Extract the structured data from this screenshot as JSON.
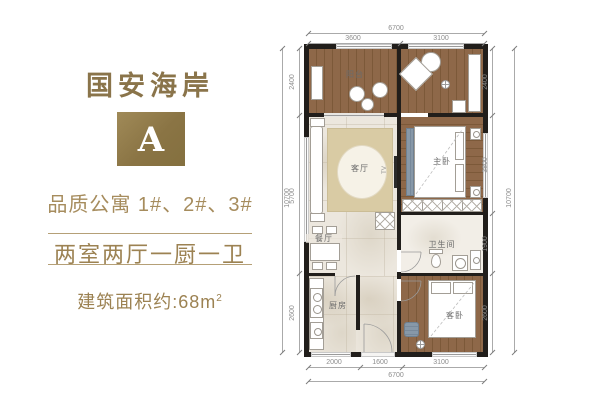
{
  "brand": {
    "title": "国安海岸",
    "unit_label": "A",
    "subtitle": "品质公寓 1#、2#、3#",
    "layout_text": "两室两厅一厨一卫",
    "area_prefix": "建筑面积约:68m",
    "area_sup": "2"
  },
  "colors": {
    "gold_text": "#8a744a",
    "gold_badge": "#8a7444",
    "divider": "#b5a077",
    "wall": "#211e1b",
    "wood_floor": "#8e6849",
    "tile_floor": "#ece7de",
    "rug": "#d9cba4",
    "accent_blue": "#8798a8",
    "dim_text": "#8d8d8d"
  },
  "plan": {
    "rooms": {
      "balcony": "阳台",
      "living": "客厅",
      "dining": "餐厅",
      "kitchen": "厨房",
      "bath": "卫生间",
      "master": "主卧",
      "guest": "客卧",
      "tv": "TV"
    },
    "dims": {
      "top_total": "6700",
      "top_segs": [
        "3600",
        "3100"
      ],
      "bottom_segs": [
        "2000",
        "1600",
        "3100"
      ],
      "bottom_total": "6700",
      "left_total": "10700",
      "left_segs": [
        "2400",
        "5700",
        "2600"
      ],
      "right_segs": [
        "2400",
        "3800",
        "1900",
        "2600"
      ],
      "right_total": "10700"
    }
  }
}
